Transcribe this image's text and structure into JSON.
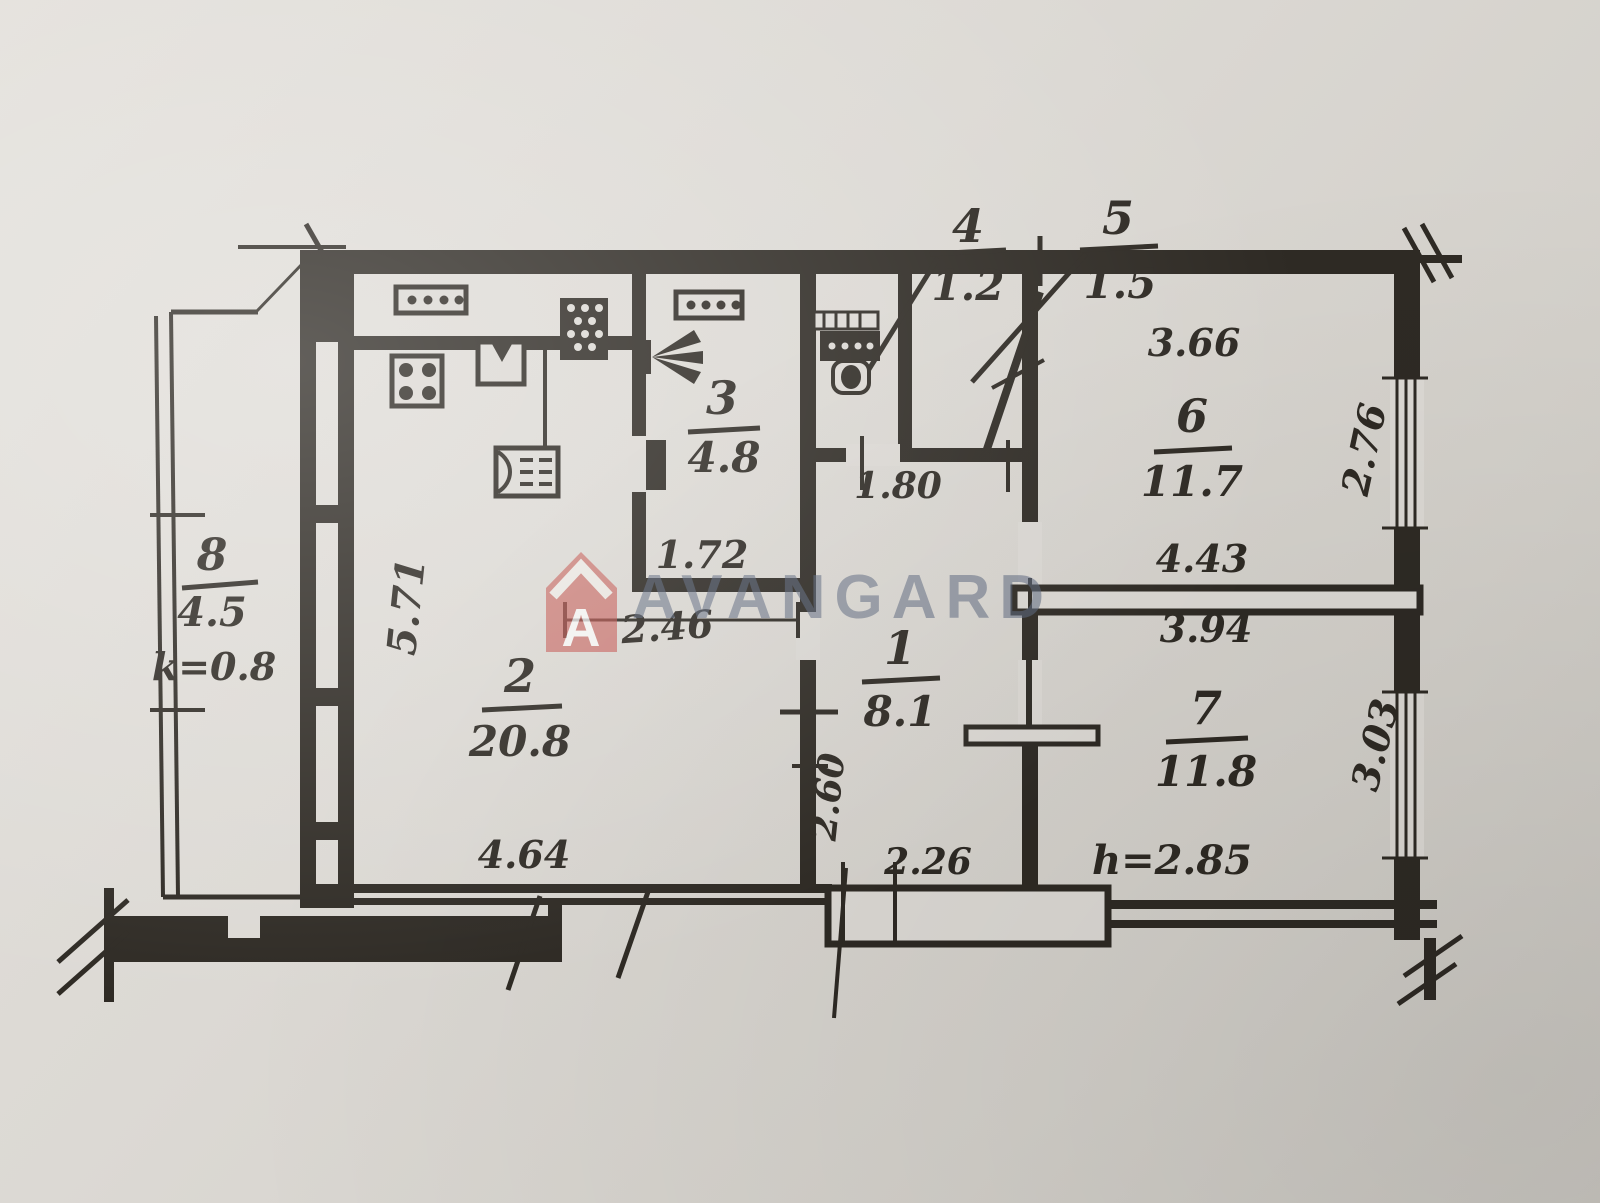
{
  "plan": {
    "kind": "apartment-floor-plan",
    "watermark": {
      "brand": "AVANGARD",
      "logo_letter": "A",
      "accent_red": "#c4534d",
      "text_color": "#5a667d"
    },
    "rooms": [
      {
        "num": "1",
        "area": "8.1"
      },
      {
        "num": "2",
        "area": "20.8"
      },
      {
        "num": "3",
        "area": "4.8"
      },
      {
        "num": "4",
        "area": "1.2"
      },
      {
        "num": "5",
        "area": "1.5"
      },
      {
        "num": "6",
        "area": "11.7"
      },
      {
        "num": "7",
        "area": "11.8"
      },
      {
        "num": "8",
        "area": "4.5"
      }
    ],
    "dims": {
      "room6_top": "3.66",
      "room6_right": "2.76",
      "wall_mid_upper": "4.43",
      "room7_top": "3.94",
      "room7_right": "3.03",
      "ceiling_height": "h=2.85",
      "hall_bottom": "2.26",
      "hall_left": "2.60",
      "hall_top": "1.80",
      "room3_bottom": "1.72",
      "kitchen_partial": "2.46",
      "kitchen_left": "5.71",
      "kitchen_bottom": "4.64",
      "balcony_coeff": "k=0.8"
    }
  }
}
